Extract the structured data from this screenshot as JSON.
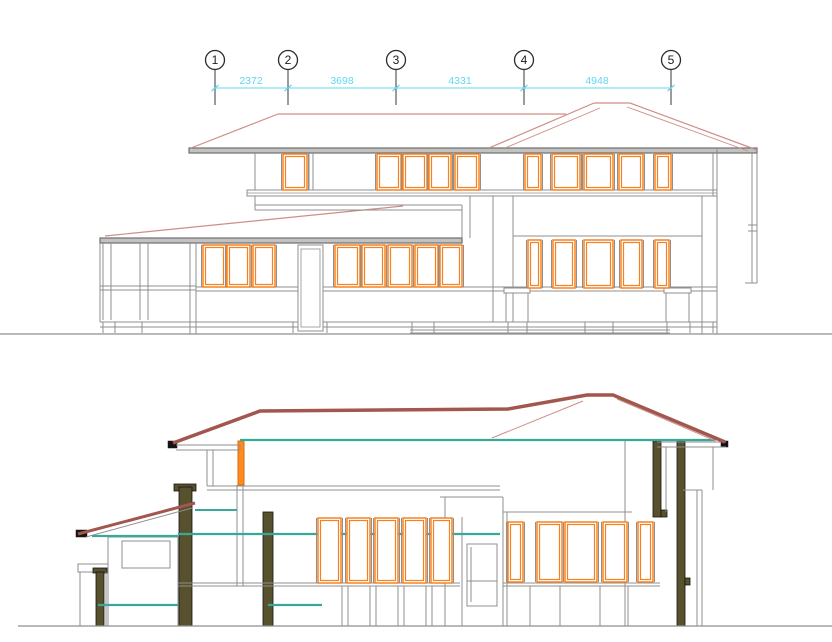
{
  "colors": {
    "white": "#ffffff",
    "gray": "#8f8f8f",
    "grayDark": "#6e6e6e",
    "fasciaFill": "#c2c2c2",
    "salmon": "#cf8d85",
    "maroon": "#a2564e",
    "orange": "#f58220",
    "orangeBright": "#ff8a1e",
    "orangeDark": "#d96c10",
    "teal": "#3aa79b",
    "olive": "#57512e",
    "black": "#141414",
    "cyan": "#62d7f2",
    "ink": "#2b2b2b",
    "none": "none"
  },
  "grid": {
    "bubble_y": 60,
    "bubble_r": 9.5,
    "stem_y1": 69.5,
    "stem_y2": 105,
    "dim_y": 88,
    "label_y": 84,
    "bubbles": [
      {
        "label": "1",
        "x": 215
      },
      {
        "label": "2",
        "x": 288
      },
      {
        "label": "3",
        "x": 396
      },
      {
        "label": "4",
        "x": 524
      },
      {
        "label": "5",
        "x": 671
      }
    ],
    "dims": [
      {
        "text": "2372",
        "cx": 251
      },
      {
        "text": "3698",
        "cx": 342
      },
      {
        "text": "4331",
        "cx": 460
      },
      {
        "text": "4948",
        "cx": 597
      }
    ]
  },
  "elevation": [
    {
      "rects": [
        [
          189,
          148,
          568,
          5,
          "grayDark",
          "fasciaFill",
          1.2
        ],
        [
          100,
          238,
          362,
          5,
          "grayDark",
          "fasciaFill",
          1.2
        ],
        [
          247,
          190,
          470,
          6,
          "gray",
          "white",
          1
        ]
      ],
      "lines": [
        [
          278,
          114,
          566,
          114,
          "salmon",
          1.2
        ],
        [
          278,
          114,
          191,
          148,
          "salmon",
          1.2
        ],
        [
          594,
          103,
          630,
          103,
          "salmon",
          1.2
        ],
        [
          594,
          103,
          489,
          148,
          "salmon",
          1.2
        ],
        [
          630,
          103,
          757,
          150,
          "salmon",
          1.2
        ],
        [
          600,
          108,
          505,
          148,
          "salmon",
          0.9
        ],
        [
          627,
          107,
          748,
          151,
          "salmon",
          0.9
        ],
        [
          105,
          236,
          403,
          206,
          "salmon",
          1.2
        ],
        [
          255,
          153,
          255,
          190
        ],
        [
          309,
          153,
          309,
          190
        ],
        [
          313,
          153,
          313,
          190
        ],
        [
          713,
          153,
          713,
          196
        ],
        [
          247,
          193,
          717,
          193,
          "gray",
          0.7
        ],
        [
          255,
          205,
          462,
          205
        ],
        [
          255,
          210,
          462,
          210
        ],
        [
          462,
          205,
          462,
          238
        ],
        [
          470,
          196,
          470,
          238
        ],
        [
          255,
          196,
          255,
          210
        ],
        [
          493,
          196,
          493,
          322
        ],
        [
          513,
          196,
          513,
          322
        ],
        [
          702,
          196,
          702,
          334
        ],
        [
          717,
          148,
          717,
          334
        ],
        [
          752,
          153,
          752,
          283
        ],
        [
          757,
          153,
          757,
          283
        ],
        [
          745,
          283,
          757,
          283
        ],
        [
          748,
          225,
          757,
          225
        ],
        [
          748,
          231,
          757,
          231
        ],
        [
          513,
          236,
          702,
          236
        ],
        [
          100,
          243,
          100,
          322
        ],
        [
          103,
          243,
          103,
          320
        ],
        [
          111,
          243,
          111,
          320
        ],
        [
          140,
          243,
          140,
          320
        ],
        [
          148,
          243,
          148,
          320
        ],
        [
          190,
          243,
          190,
          334
        ],
        [
          196,
          243,
          196,
          334
        ],
        [
          100,
          286,
          196,
          286
        ],
        [
          100,
          290,
          196,
          290
        ],
        [
          196,
          287,
          717,
          287
        ],
        [
          196,
          291,
          717,
          291
        ],
        [
          100,
          322,
          717,
          322
        ],
        [
          100,
          327,
          717,
          327
        ],
        [
          410,
          330,
          670,
          330
        ],
        [
          410,
          333,
          670,
          333
        ],
        [
          506,
          293,
          506,
          322
        ],
        [
          528,
          293,
          528,
          322
        ],
        [
          666,
          293,
          666,
          322
        ],
        [
          689,
          293,
          689,
          322
        ],
        [
          103,
          322,
          103,
          333
        ],
        [
          115,
          322,
          115,
          333
        ],
        [
          142,
          322,
          142,
          333
        ],
        [
          190,
          322,
          190,
          333
        ],
        [
          196,
          322,
          196,
          333
        ],
        [
          293,
          322,
          293,
          333
        ],
        [
          327,
          322,
          327,
          333
        ],
        [
          412,
          322,
          412,
          333
        ],
        [
          434,
          322,
          434,
          333
        ],
        [
          508,
          322,
          508,
          333
        ],
        [
          527,
          322,
          527,
          333
        ],
        [
          585,
          322,
          585,
          333
        ],
        [
          613,
          322,
          613,
          333
        ],
        [
          667,
          322,
          667,
          333
        ],
        [
          690,
          322,
          690,
          333
        ],
        [
          713,
          322,
          713,
          333
        ],
        [
          0,
          334,
          832,
          334,
          "gray",
          1.3
        ]
      ]
    },
    {
      "rects": [
        [
          298,
          245,
          25,
          86,
          "gray",
          "white",
          1
        ],
        [
          301,
          249,
          19,
          78,
          "gray",
          "none",
          0.8
        ],
        [
          504,
          288,
          26,
          5,
          "gray",
          "white",
          1
        ],
        [
          664,
          288,
          27,
          5,
          "gray",
          "white",
          1
        ]
      ],
      "windows": [
        [
          283,
          154,
          24,
          36
        ],
        [
          377,
          154,
          24,
          36
        ],
        [
          403,
          154,
          24,
          36
        ],
        [
          429,
          154,
          22,
          36
        ],
        [
          455,
          154,
          24,
          36
        ],
        [
          525,
          154,
          16,
          36
        ],
        [
          552,
          154,
          28,
          36
        ],
        [
          584,
          154,
          29,
          36
        ],
        [
          619,
          154,
          24,
          36
        ],
        [
          655,
          154,
          16,
          36
        ],
        [
          203,
          245,
          23,
          42
        ],
        [
          227,
          245,
          23,
          42
        ],
        [
          253,
          245,
          22,
          42
        ],
        [
          335,
          245,
          25,
          42
        ],
        [
          362,
          245,
          23,
          42
        ],
        [
          388,
          245,
          24,
          42
        ],
        [
          415,
          245,
          23,
          42
        ],
        [
          440,
          245,
          22,
          42
        ],
        [
          528,
          240,
          13,
          48
        ],
        [
          553,
          240,
          22,
          48
        ],
        [
          584,
          240,
          29,
          48
        ],
        [
          621,
          240,
          21,
          48
        ],
        [
          655,
          240,
          14,
          48
        ]
      ]
    }
  ],
  "section": [
    {
      "rects": [
        [
          108,
          537,
          70,
          89,
          "gray",
          "none",
          1
        ],
        [
          122,
          541,
          48,
          27,
          "gray",
          "white",
          1
        ],
        [
          78,
          564,
          30,
          8,
          "gray",
          "white",
          1
        ],
        [
          467,
          544,
          30,
          62,
          "gray",
          "white",
          1
        ],
        [
          174,
          484,
          22,
          7,
          "black",
          "olive",
          0.8
        ],
        [
          179,
          487,
          13,
          139,
          "black",
          "olive",
          0.8
        ],
        [
          263,
          512,
          10,
          114,
          "black",
          "olive",
          0.8
        ],
        [
          653,
          441,
          8,
          76,
          "black",
          "olive",
          0.8
        ],
        [
          661,
          510,
          6,
          7,
          "black",
          "olive",
          0.8
        ],
        [
          677,
          441,
          8,
          185,
          "black",
          "olive",
          0.8
        ],
        [
          685,
          578,
          5,
          7,
          "black",
          "olive",
          0.8
        ],
        [
          93,
          568,
          14,
          5,
          "black",
          "olive",
          0.8
        ],
        [
          96,
          572,
          8,
          54,
          "black",
          "olive",
          0.8
        ],
        [
          168,
          441,
          9,
          7,
          "black",
          "black",
          0.5
        ],
        [
          76,
          530,
          11,
          7,
          "black",
          "black",
          0.5
        ],
        [
          721,
          441,
          7,
          6,
          "black",
          "black",
          0.5
        ],
        [
          238,
          441,
          6,
          44,
          "orangeDark",
          "orangeBright",
          1
        ]
      ],
      "lines": [
        [
          176,
          445,
          240,
          445
        ],
        [
          176,
          450,
          240,
          450
        ],
        [
          240,
          445,
          240,
          450
        ],
        [
          657,
          442,
          726,
          442
        ],
        [
          657,
          447,
          726,
          447
        ],
        [
          86,
          537,
          192,
          508
        ],
        [
          207,
          450,
          207,
          486
        ],
        [
          213,
          450,
          213,
          486
        ],
        [
          207,
          486,
          500,
          486
        ],
        [
          207,
          490,
          500,
          490
        ],
        [
          237,
          485,
          237,
          586
        ],
        [
          243,
          485,
          243,
          586
        ],
        [
          108,
          538,
          108,
          626
        ],
        [
          80,
          572,
          80,
          626
        ],
        [
          106,
          572,
          106,
          626
        ],
        [
          178,
          583,
          460,
          583
        ],
        [
          178,
          586,
          460,
          586
        ],
        [
          342,
          586,
          342,
          626
        ],
        [
          348,
          586,
          348,
          626
        ],
        [
          370,
          586,
          370,
          626
        ],
        [
          376,
          586,
          376,
          626
        ],
        [
          398,
          586,
          398,
          626
        ],
        [
          404,
          586,
          404,
          626
        ],
        [
          426,
          586,
          426,
          626
        ],
        [
          432,
          586,
          432,
          626
        ],
        [
          445,
          497,
          445,
          626
        ],
        [
          462,
          517,
          462,
          626
        ],
        [
          503,
          497,
          503,
          626
        ],
        [
          507,
          512,
          507,
          626
        ],
        [
          440,
          497,
          503,
          497
        ],
        [
          503,
          512,
          632,
          512
        ],
        [
          471,
          547,
          471,
          602
        ],
        [
          467,
          581,
          497,
          581
        ],
        [
          503,
          583,
          660,
          583
        ],
        [
          503,
          586,
          660,
          586
        ],
        [
          530,
          586,
          530,
          626
        ],
        [
          560,
          586,
          560,
          626
        ],
        [
          600,
          586,
          600,
          626
        ],
        [
          628,
          586,
          628,
          626
        ],
        [
          625,
          440,
          625,
          626
        ],
        [
          697,
          490,
          697,
          626
        ],
        [
          702,
          490,
          702,
          626
        ],
        [
          683,
          490,
          702,
          490
        ],
        [
          666,
          447,
          666,
          512
        ],
        [
          713,
          447,
          713,
          490
        ],
        [
          18,
          626,
          832,
          626,
          "gray",
          1.3
        ]
      ]
    },
    {
      "windows": [
        [
          318,
          518,
          23,
          65
        ],
        [
          347,
          518,
          23,
          65
        ],
        [
          375,
          518,
          23,
          65
        ],
        [
          403,
          518,
          23,
          65
        ],
        [
          431,
          518,
          21,
          65
        ],
        [
          508,
          522,
          15,
          60
        ],
        [
          537,
          522,
          25,
          60
        ],
        [
          565,
          522,
          32,
          60
        ],
        [
          603,
          522,
          24,
          60
        ],
        [
          638,
          522,
          15,
          60
        ]
      ],
      "lines": [
        [
          240,
          440,
          715,
          440,
          "teal",
          2.2
        ],
        [
          92,
          536,
          178,
          536,
          "teal",
          2.2
        ],
        [
          195,
          510,
          237,
          510,
          "teal",
          2
        ],
        [
          178,
          534,
          500,
          534,
          "teal",
          2.2
        ],
        [
          98,
          605,
          178,
          605,
          "teal",
          2.2
        ],
        [
          268,
          605,
          322,
          605,
          "teal",
          2.2
        ],
        [
          492,
          438,
          583,
          401,
          "salmon",
          1
        ],
        [
          617,
          399,
          716,
          441,
          "salmon",
          1
        ]
      ],
      "polys": [
        {
          "p": [
            [
              173,
              443
            ],
            [
              260,
              411
            ],
            [
              508,
              409
            ],
            [
              587,
              395
            ],
            [
              613,
              395
            ],
            [
              725,
              442
            ]
          ],
          "c": "maroon",
          "w": 3.5
        },
        {
          "p": [
            [
              78,
              534
            ],
            [
              195,
              503
            ]
          ],
          "c": "maroon",
          "w": 3
        }
      ]
    }
  ]
}
